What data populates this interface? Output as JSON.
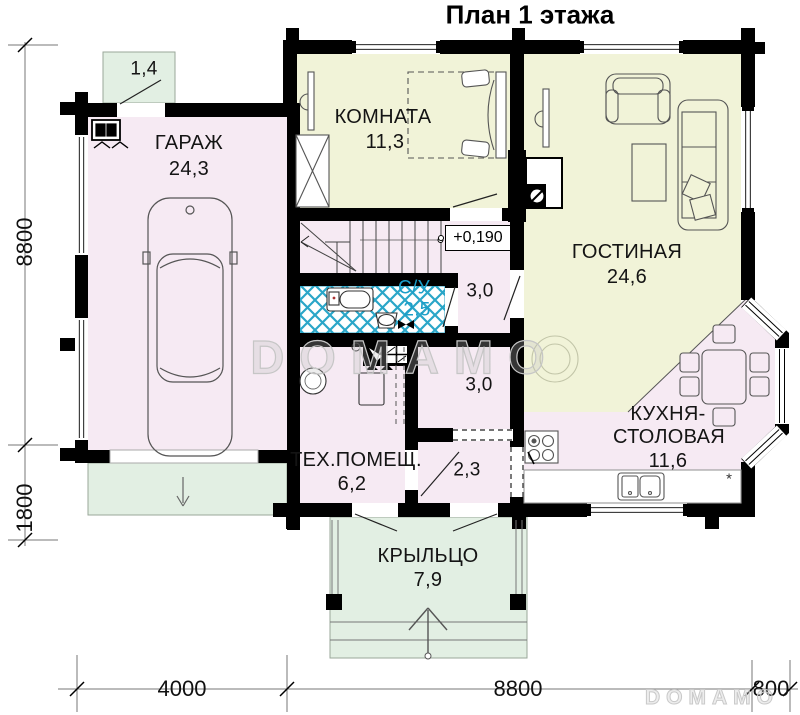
{
  "title": "План 1 этажа",
  "level_mark": "+0,190",
  "note_mark": "*",
  "rooms": {
    "vestibule": {
      "area": "1,4"
    },
    "garage": {
      "name": "ГАРАЖ",
      "area": "24,3"
    },
    "bedroom": {
      "name": "КОМНАТА",
      "area": "11,3"
    },
    "living": {
      "name": "ГОСТИНАЯ",
      "area": "24,6"
    },
    "bathroom": {
      "name": "С/У",
      "area": "2,5"
    },
    "hall_upper": {
      "area": "3,0"
    },
    "hall_lower": {
      "area": "3,0"
    },
    "tech": {
      "name": "ТЕХ.ПОМЕЩ.",
      "area": "6,2"
    },
    "entry": {
      "area": "2,3"
    },
    "kitchen": {
      "name_line1": "КУХНЯ-",
      "name_line2": "СТОЛОВАЯ",
      "area": "11,6"
    },
    "porch": {
      "name": "КРЫЛЬЦО",
      "area": "7,9"
    }
  },
  "dimensions": {
    "vertical": [
      "8800",
      "1800"
    ],
    "horizontal": [
      "4000",
      "8800",
      "800"
    ]
  },
  "watermark": {
    "text": "DOMAMO"
  },
  "colors": {
    "room_pink": "#f6eaf3",
    "room_yellow": "#f1f3d8",
    "outdoor_green": "#e2efe3",
    "tile_blue": "#2aa6c8",
    "bath_label_blue": "#1b9ec8",
    "wall_black": "#000000",
    "watermark_gray": "#c8c8c8"
  }
}
